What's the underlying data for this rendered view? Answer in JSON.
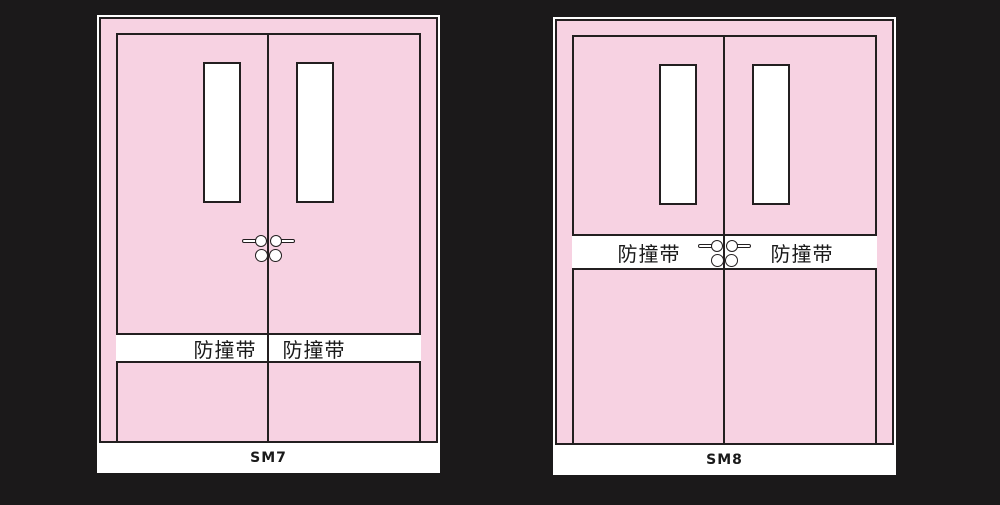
{
  "colors": {
    "background": "#1b191a",
    "door_pink": "#f7d2e2",
    "outline": "#231f20",
    "white": "#ffffff"
  },
  "doors": [
    {
      "caption": "SM7",
      "bumper_strip": {
        "left": "防撞带",
        "right": "防撞带"
      }
    },
    {
      "caption": "SM8",
      "bumper_strip": {
        "left": "防撞带",
        "right": "防撞带"
      }
    }
  ]
}
